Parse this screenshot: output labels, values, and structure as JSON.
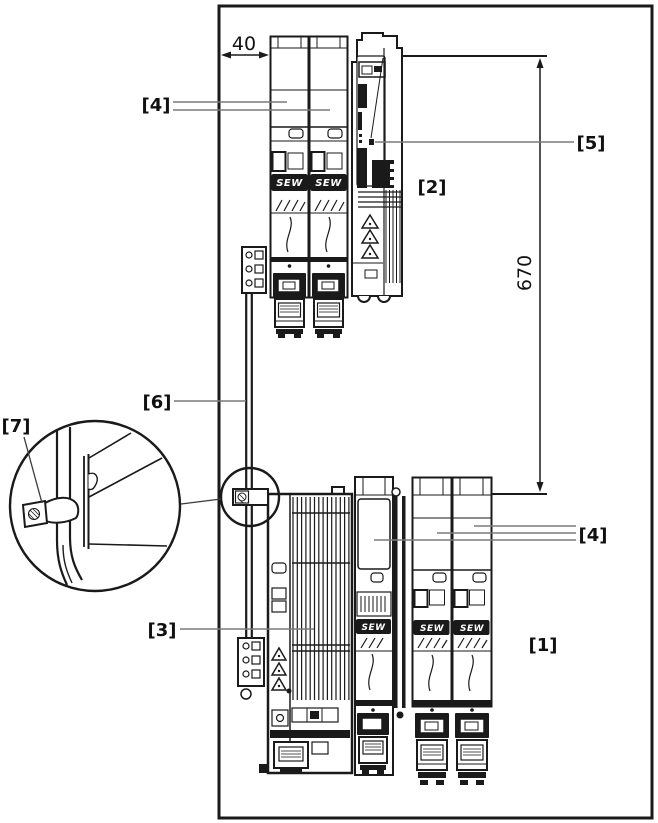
{
  "diagram": {
    "background": "#ffffff",
    "line_color": "#1a1a1a",
    "leader_color": "#7a7a7a",
    "brand_logo": "SEW",
    "dimensions": {
      "side_clearance_mm": "40",
      "vertical_spacing_mm": "670"
    },
    "callouts": {
      "c1": "[1]",
      "c2": "[2]",
      "c3": "[3]",
      "c4": "[4]",
      "c5": "[5]",
      "c6": "[6]",
      "c7": "[7]"
    }
  }
}
